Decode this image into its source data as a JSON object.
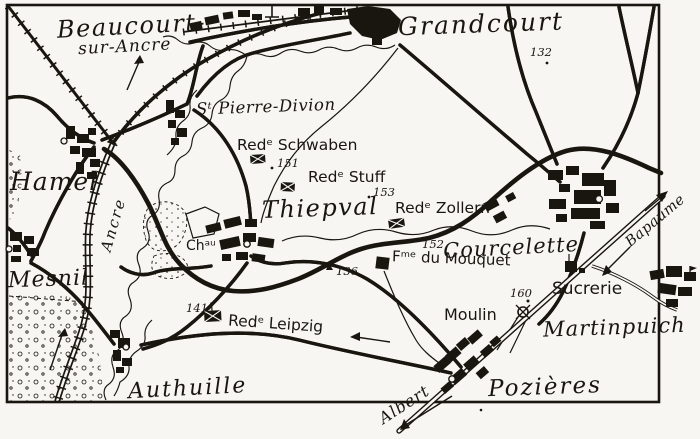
{
  "map": {
    "villages": {
      "beaucourt_line1": "Beaucourt-",
      "beaucourt_line2": "sur-Ancre",
      "grandcourt": "Grandcourt",
      "st_pierre_divion": "Sᵗ Pierre-Divion",
      "hamel": "Hamel",
      "mesnil": "Mesnil",
      "thiepval": "Thiepval",
      "authuille": "Authuille",
      "courcelette": "Courcelette",
      "pozieres": "Pozières",
      "martinpuich": "Martinpuich"
    },
    "redoubts": {
      "schwaben": "Redᵉ Schwaben",
      "stuff": "Redᵉ Stuff",
      "zollern": "Redᵉ Zollern",
      "leipzig": "Redᵉ Leipzig"
    },
    "features": {
      "chateau": "Chᵃᵘ",
      "mouquet_farm": "Fᵐᵉ du Mouquet",
      "windmill": "Moulin",
      "sugar_factory": "Sucrerie",
      "river_ancre": "Ancre"
    },
    "spot_heights": {
      "h132": "132",
      "h151": "151",
      "h153": "153",
      "h152": "152",
      "h136": "136",
      "h141": "141",
      "h160": "160"
    },
    "road_directions": {
      "albert": "Albert",
      "bapaume": "Bapaume"
    },
    "colors": {
      "ink": "#191610",
      "paper": "#f7f6f2"
    }
  }
}
